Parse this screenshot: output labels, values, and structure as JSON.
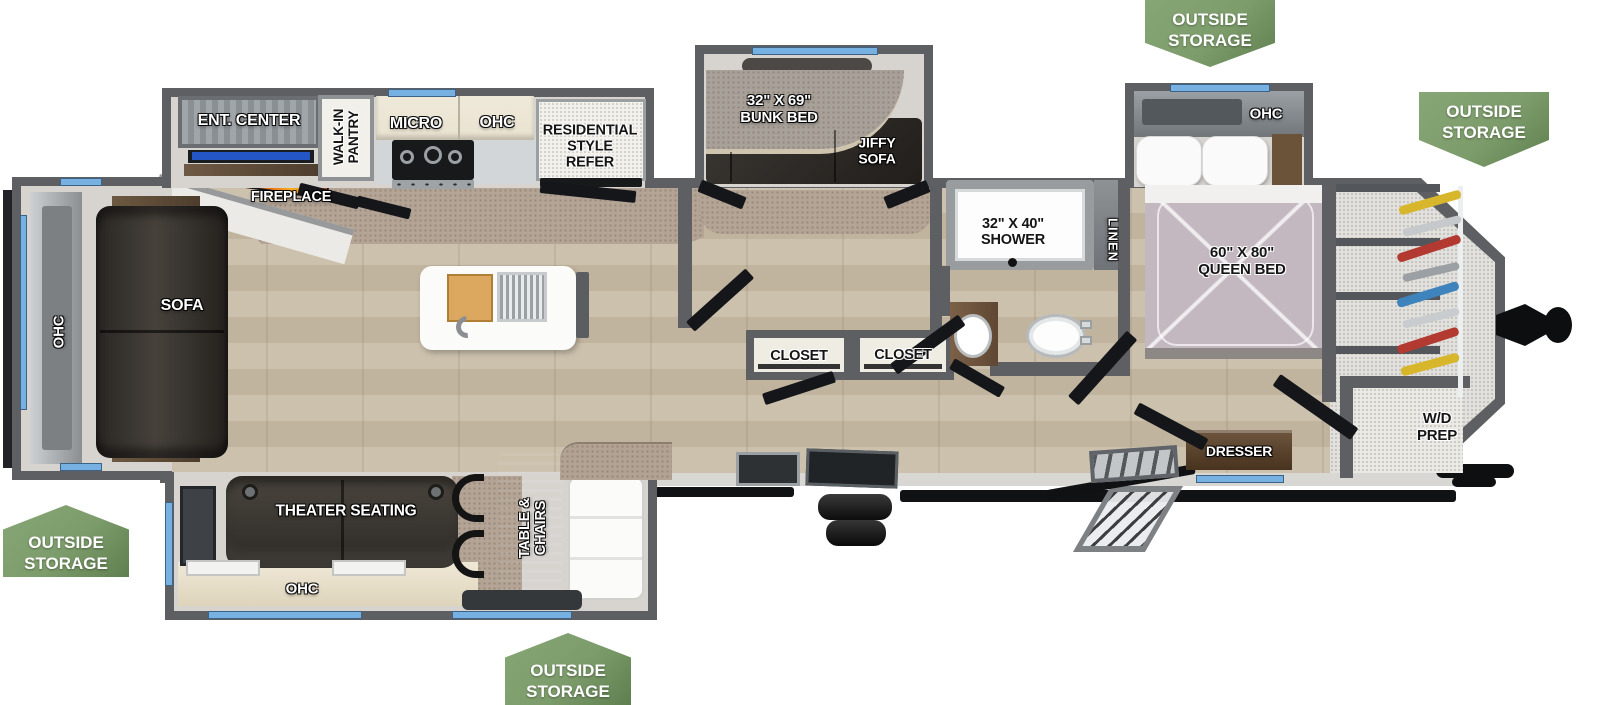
{
  "title": "RV travel trailer floor plan",
  "badges": {
    "top": "OUTSIDE\nSTORAGE",
    "front": "OUTSIDE\nSTORAGE",
    "rear": "OUTSIDE\nSTORAGE",
    "bottom": "OUTSIDE\nSTORAGE"
  },
  "labels": {
    "ent_center": "ENT. CENTER",
    "walk_in_pantry": "WALK-IN\nPANTRY",
    "micro": "MICRO",
    "kitchen_ohc": "OHC",
    "refer": "RESIDENTIAL\nSTYLE\nREFER",
    "fireplace": "FIREPLACE",
    "rear_ohc": "OHC",
    "sofa": "SOFA",
    "bunk_bed": "32\" X 69\"\nBUNK BED",
    "jiffy_sofa": "JIFFY\nSOFA",
    "shower": "32\" X 40\"\nSHOWER",
    "linen": "LINEN",
    "closet_left": "CLOSET",
    "closet_right": "CLOSET",
    "bedroom_ohc": "OHC",
    "queen_bed": "60\" X 80\"\nQUEEN BED",
    "dresser": "DRESSER",
    "wd_prep": "W/D\nPREP",
    "theater_seating": "THEATER SEATING",
    "bottom_ohc": "OHC",
    "table_chairs": "TABLE &\nCHAIRS"
  },
  "colors": {
    "wall": "#5d5f62",
    "slide_floor": "#d7d4d0",
    "wood_a": "#ccc1ad",
    "wood_b": "#c1b49e",
    "carpet": "#b3a496",
    "granite": "#b1a294",
    "badge_green": "#7d9c6b",
    "badge_green_dark": "#5f7f50",
    "window_blue": "#76b1e2",
    "furniture_dark": "#37332e",
    "bed_quilt": "#c3b8c0",
    "cabinet_cream": "#e9e2d0",
    "flame_a": "#c22c0e",
    "flame_b": "#f6b020",
    "tv_blue": "#2456c6",
    "exterior_black": "#101214"
  }
}
